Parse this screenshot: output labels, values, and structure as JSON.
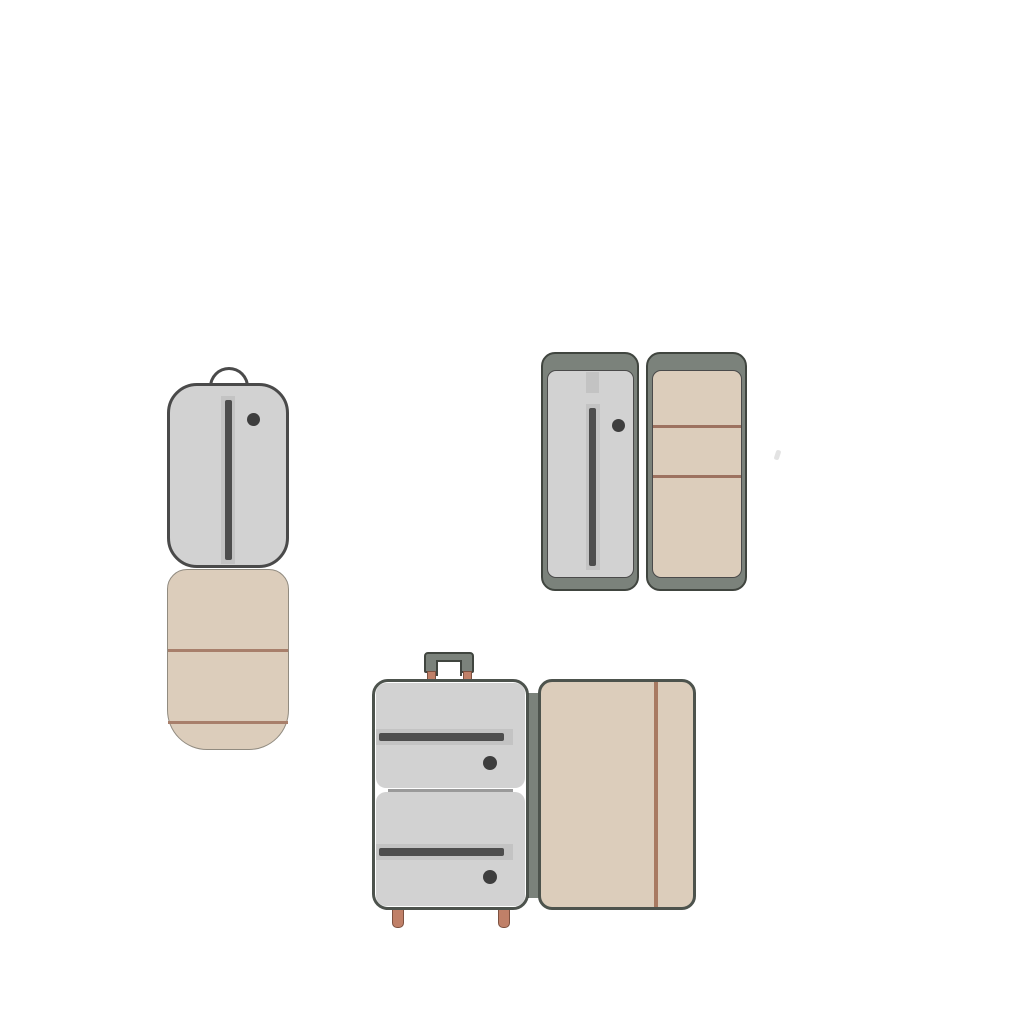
{
  "scene": {
    "background": "#ffffff",
    "description": "Flat vector illustration set of three opened luggage pieces on a white background",
    "objects": [
      {
        "id": "garment-bag",
        "label": "Folded garment bag: gray zippered top flap with handle loop and snap dot, beige lower half with two horizontal trim lines"
      },
      {
        "id": "flat-open-suitcase",
        "label": "Suitcase opened flat: green-gray shell halves, left gray liner with vertical zipper and snap dot, right beige liner with two horizontal straps"
      },
      {
        "id": "trolley-suitcase",
        "label": "Open trolley suitcase: telescopic handle, two gray zip pockets with snap dots, salmon feet, hinged beige lid with vertical strap"
      }
    ]
  },
  "palette": {
    "canvas": "#ffffff",
    "panel_gray": "#d2d2d2",
    "band_gray": "#c3c3c3",
    "zipper_dark": "#4d4d4d",
    "dot_dark": "#3e3e3e",
    "outline_dark": "#4a4a4a",
    "frame_green": "#7b827b",
    "frame_border": "#40453f",
    "shell_border": "#4d534d",
    "beige": "#dccdbb",
    "beige_outline": "#918b80",
    "strap_brown": "#9d7260",
    "bag_line_brown": "#a87f6b",
    "lid_line_brown": "#a87a62",
    "salmon": "#c08068",
    "salmon_border": "#7d5140",
    "divider_gray": "#9a9a9a"
  }
}
